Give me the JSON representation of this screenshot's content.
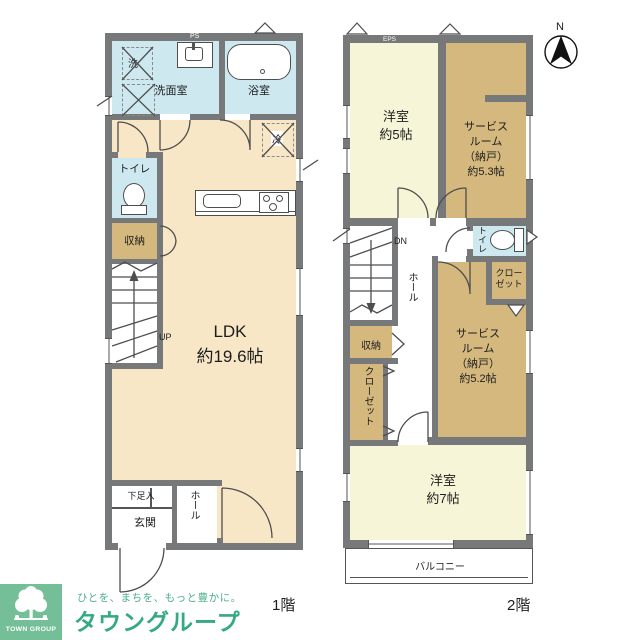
{
  "floor1": {
    "label": "1階",
    "washroom": "洗面室",
    "bath": "浴室",
    "washer": "洗",
    "ps": "PS",
    "toilet": "トイレ",
    "storage": "収納",
    "up": "UP",
    "ldk_name": "LDK",
    "ldk_size": "約19.6帖",
    "fridge": "冷",
    "shoe_box": "下足入",
    "entrance": "玄関",
    "hall": "ホール"
  },
  "floor2": {
    "label": "2階",
    "eps": "EPS",
    "room5_name": "洋室",
    "room5_size": "約5帖",
    "service_53": "サービス\nルーム\n（納戸）\n約5.3帖",
    "dn": "DN",
    "hall": "ホール",
    "toilet": "トイレ",
    "closet_right": "クロー\nゼット",
    "storage": "収納",
    "closet_left": "クローゼット",
    "service_52": "サービス\nルーム\n（納戸）\n約5.2帖",
    "room7_name": "洋室",
    "room7_size": "約7帖",
    "balcony": "バルコニー"
  },
  "compass": {
    "north": "N"
  },
  "logo": {
    "tagline": "ひとを、まちを、もっと豊かに。",
    "brand": "タウングループ",
    "badge": "TOWN GROUP"
  },
  "colors": {
    "wall": "#77787a",
    "room_cream": "#f8e7c6",
    "room_pale_yellow": "#f7f5d8",
    "room_tan": "#d4b87e",
    "room_blue": "#cde9ef",
    "line": "#4e4e4e",
    "logo_green": "#74bf98",
    "logo_text_green": "#35a983"
  }
}
